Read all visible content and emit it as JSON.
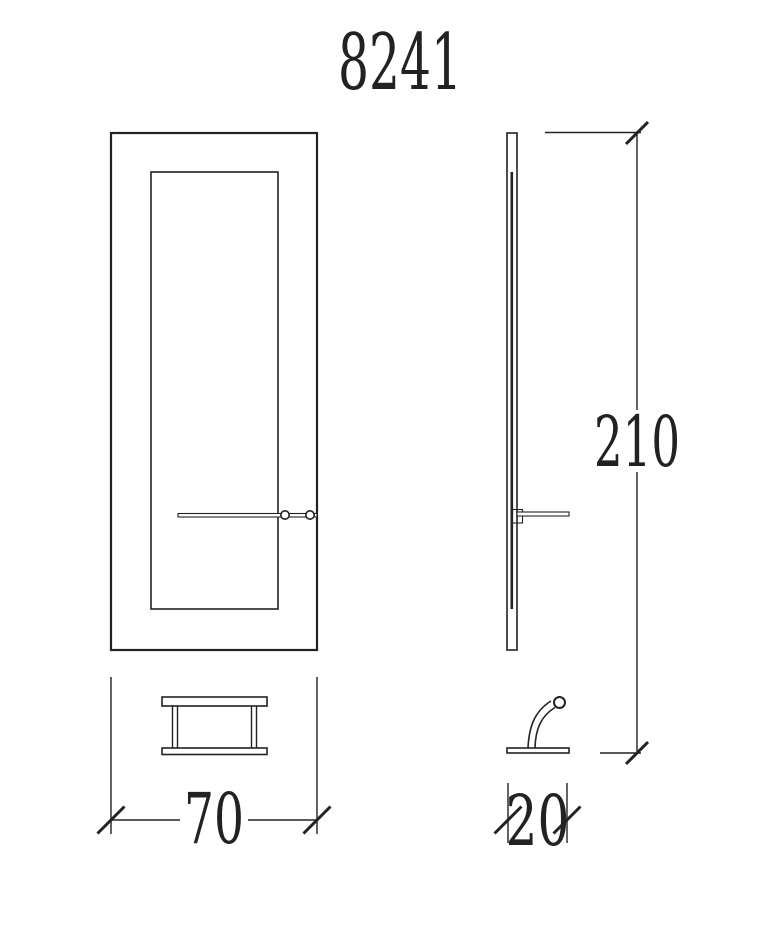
{
  "drawing": {
    "title": "8241",
    "line_color": "#222222",
    "background_color": "#ffffff",
    "dimensions": {
      "height": "210",
      "width": "70",
      "depth": "20"
    }
  }
}
